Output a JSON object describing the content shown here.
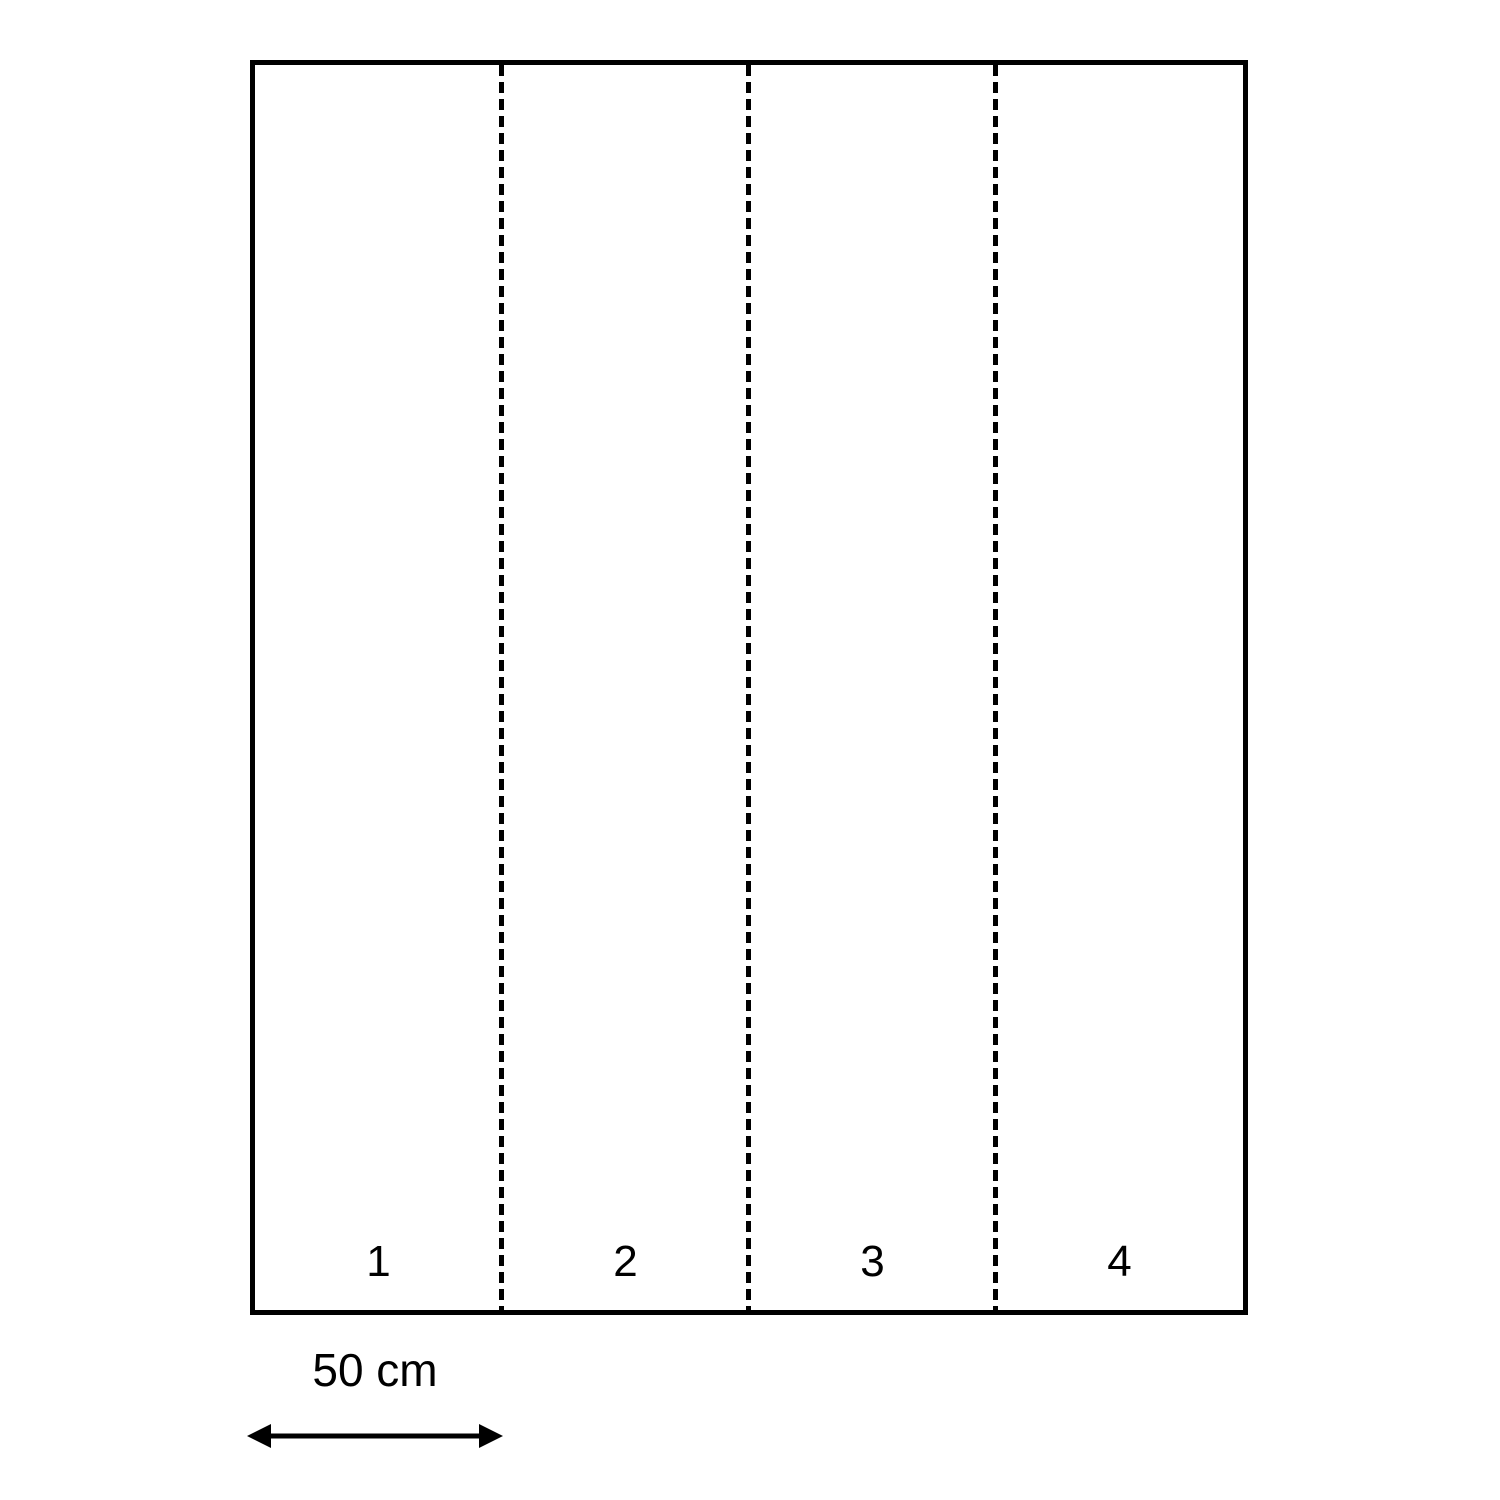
{
  "figure": {
    "description": "Rectangle divided into four equal vertical strips by dashed fold lines, with a scale arrow showing the width of one strip",
    "strips": [
      {
        "label": "1"
      },
      {
        "label": "2"
      },
      {
        "label": "3"
      },
      {
        "label": "4"
      }
    ],
    "scale": {
      "label": "50 cm"
    },
    "colors": {
      "stroke": "#000000",
      "background": "#ffffff"
    }
  }
}
